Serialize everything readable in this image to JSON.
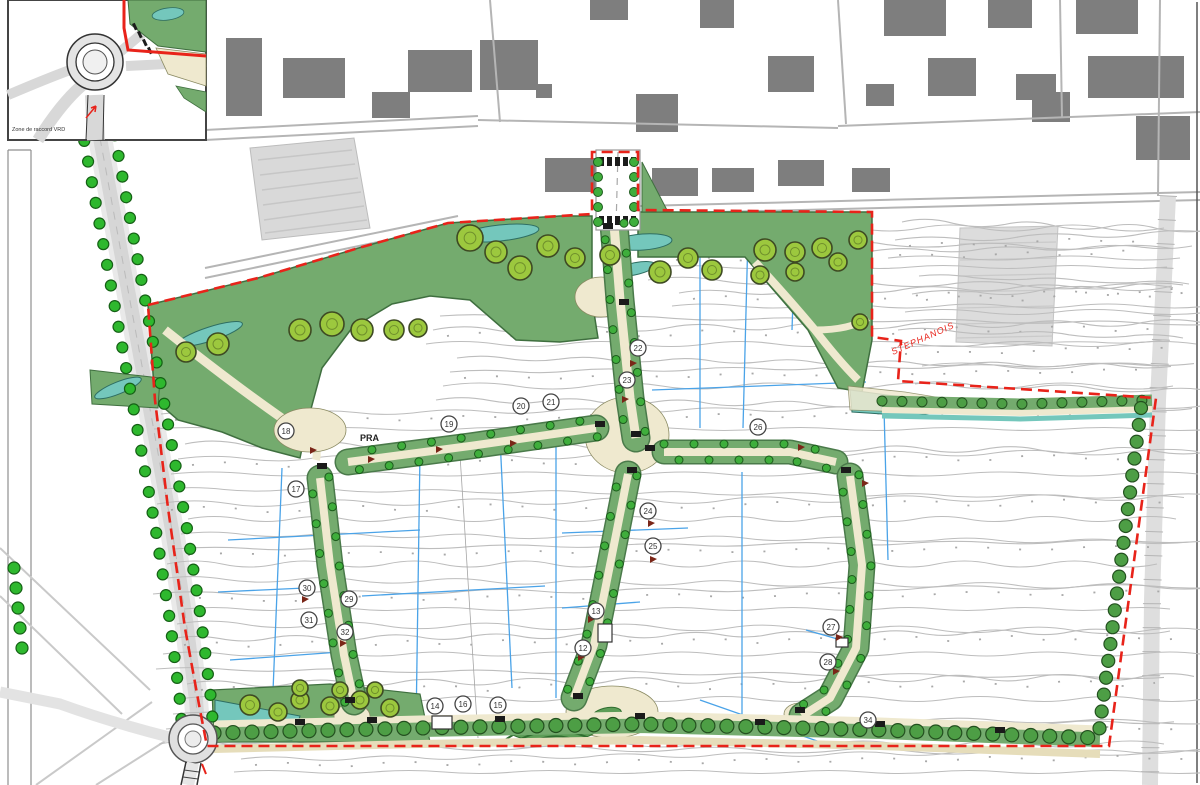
{
  "map": {
    "inset_caption": "Zone de raccord VRD",
    "road_label": "STEPHANOIS",
    "area_label": "PRA",
    "colors": {
      "boundary_red": "#e8231a",
      "corridor_green": "#74ab6e",
      "tree_green": "#3fae3c",
      "canopy_green": "#9cc83e",
      "water_teal": "#74c7bc",
      "drain_blue": "#4aa3e8",
      "path_beige": "#efe9cf",
      "building_gray": "#7e7e7e",
      "contour_gray": "#bdbdbd"
    },
    "markers": [
      {
        "x": 286,
        "y": 431,
        "label": "18"
      },
      {
        "x": 296,
        "y": 489,
        "label": "17"
      },
      {
        "x": 449,
        "y": 424,
        "label": "19"
      },
      {
        "x": 521,
        "y": 406,
        "label": "20"
      },
      {
        "x": 551,
        "y": 402,
        "label": "21"
      },
      {
        "x": 638,
        "y": 348,
        "label": "22"
      },
      {
        "x": 627,
        "y": 380,
        "label": "23"
      },
      {
        "x": 648,
        "y": 511,
        "label": "24"
      },
      {
        "x": 653,
        "y": 546,
        "label": "25"
      },
      {
        "x": 758,
        "y": 427,
        "label": "26"
      },
      {
        "x": 831,
        "y": 627,
        "label": "27"
      },
      {
        "x": 828,
        "y": 662,
        "label": "28"
      },
      {
        "x": 349,
        "y": 599,
        "label": "29"
      },
      {
        "x": 307,
        "y": 588,
        "label": "30"
      },
      {
        "x": 309,
        "y": 620,
        "label": "31"
      },
      {
        "x": 345,
        "y": 632,
        "label": "32"
      },
      {
        "x": 596,
        "y": 611,
        "label": "13"
      },
      {
        "x": 583,
        "y": 648,
        "label": "12"
      },
      {
        "x": 435,
        "y": 706,
        "label": "14"
      },
      {
        "x": 463,
        "y": 704,
        "label": "16"
      },
      {
        "x": 498,
        "y": 705,
        "label": "15"
      },
      {
        "x": 868,
        "y": 720,
        "label": "34"
      }
    ]
  }
}
